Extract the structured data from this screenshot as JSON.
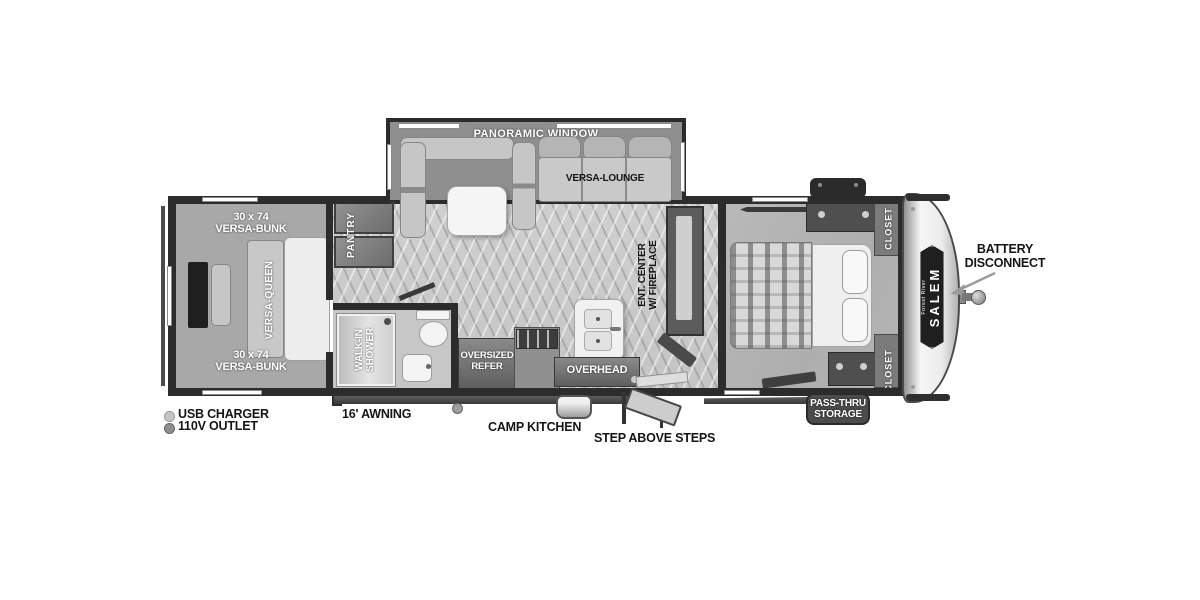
{
  "floorplan": {
    "brand": "SALEM",
    "brand_sub": "Forest River",
    "slideout": {
      "window_label": "PANORAMIC WINDOW",
      "lounge_label": "VERSA-LOUNGE"
    },
    "bunk_room": {
      "bunk_top_size": "30 x 74",
      "bunk_top_name": "VERSA-BUNK",
      "queen_label": "VERSA-QUEEN",
      "bunk_bottom_size": "30 x 74",
      "bunk_bottom_name": "VERSA-BUNK"
    },
    "kitchen": {
      "pantry": "PANTRY",
      "refer_line1": "OVERSIZED",
      "refer_line2": "REFER",
      "overhead": "OVERHEAD"
    },
    "bathroom": {
      "shower_line1": "WALK-IN",
      "shower_line2": "SHOWER"
    },
    "living": {
      "ent_center_line1": "ENT. CENTER",
      "ent_center_line2": "W/ FIREPLACE"
    },
    "bedroom": {
      "closet_top": "CLOSET",
      "closet_bottom": "CLOSET"
    },
    "exterior": {
      "battery_line1": "BATTERY",
      "battery_line2": "DISCONNECT",
      "pass_thru_line1": "PASS-THRU",
      "pass_thru_line2": "STORAGE",
      "usb_charger": "USB CHARGER",
      "outlet_110v": "110V OUTLET",
      "awning": "16' AWNING",
      "camp_kitchen": "CAMP KITCHEN",
      "steps": "STEP ABOVE STEPS"
    },
    "colors": {
      "wall": "#2c2c2c",
      "floor": "#cccccc",
      "carpet": "#a8a8a8",
      "cabinet": "#6e6e6e"
    }
  }
}
